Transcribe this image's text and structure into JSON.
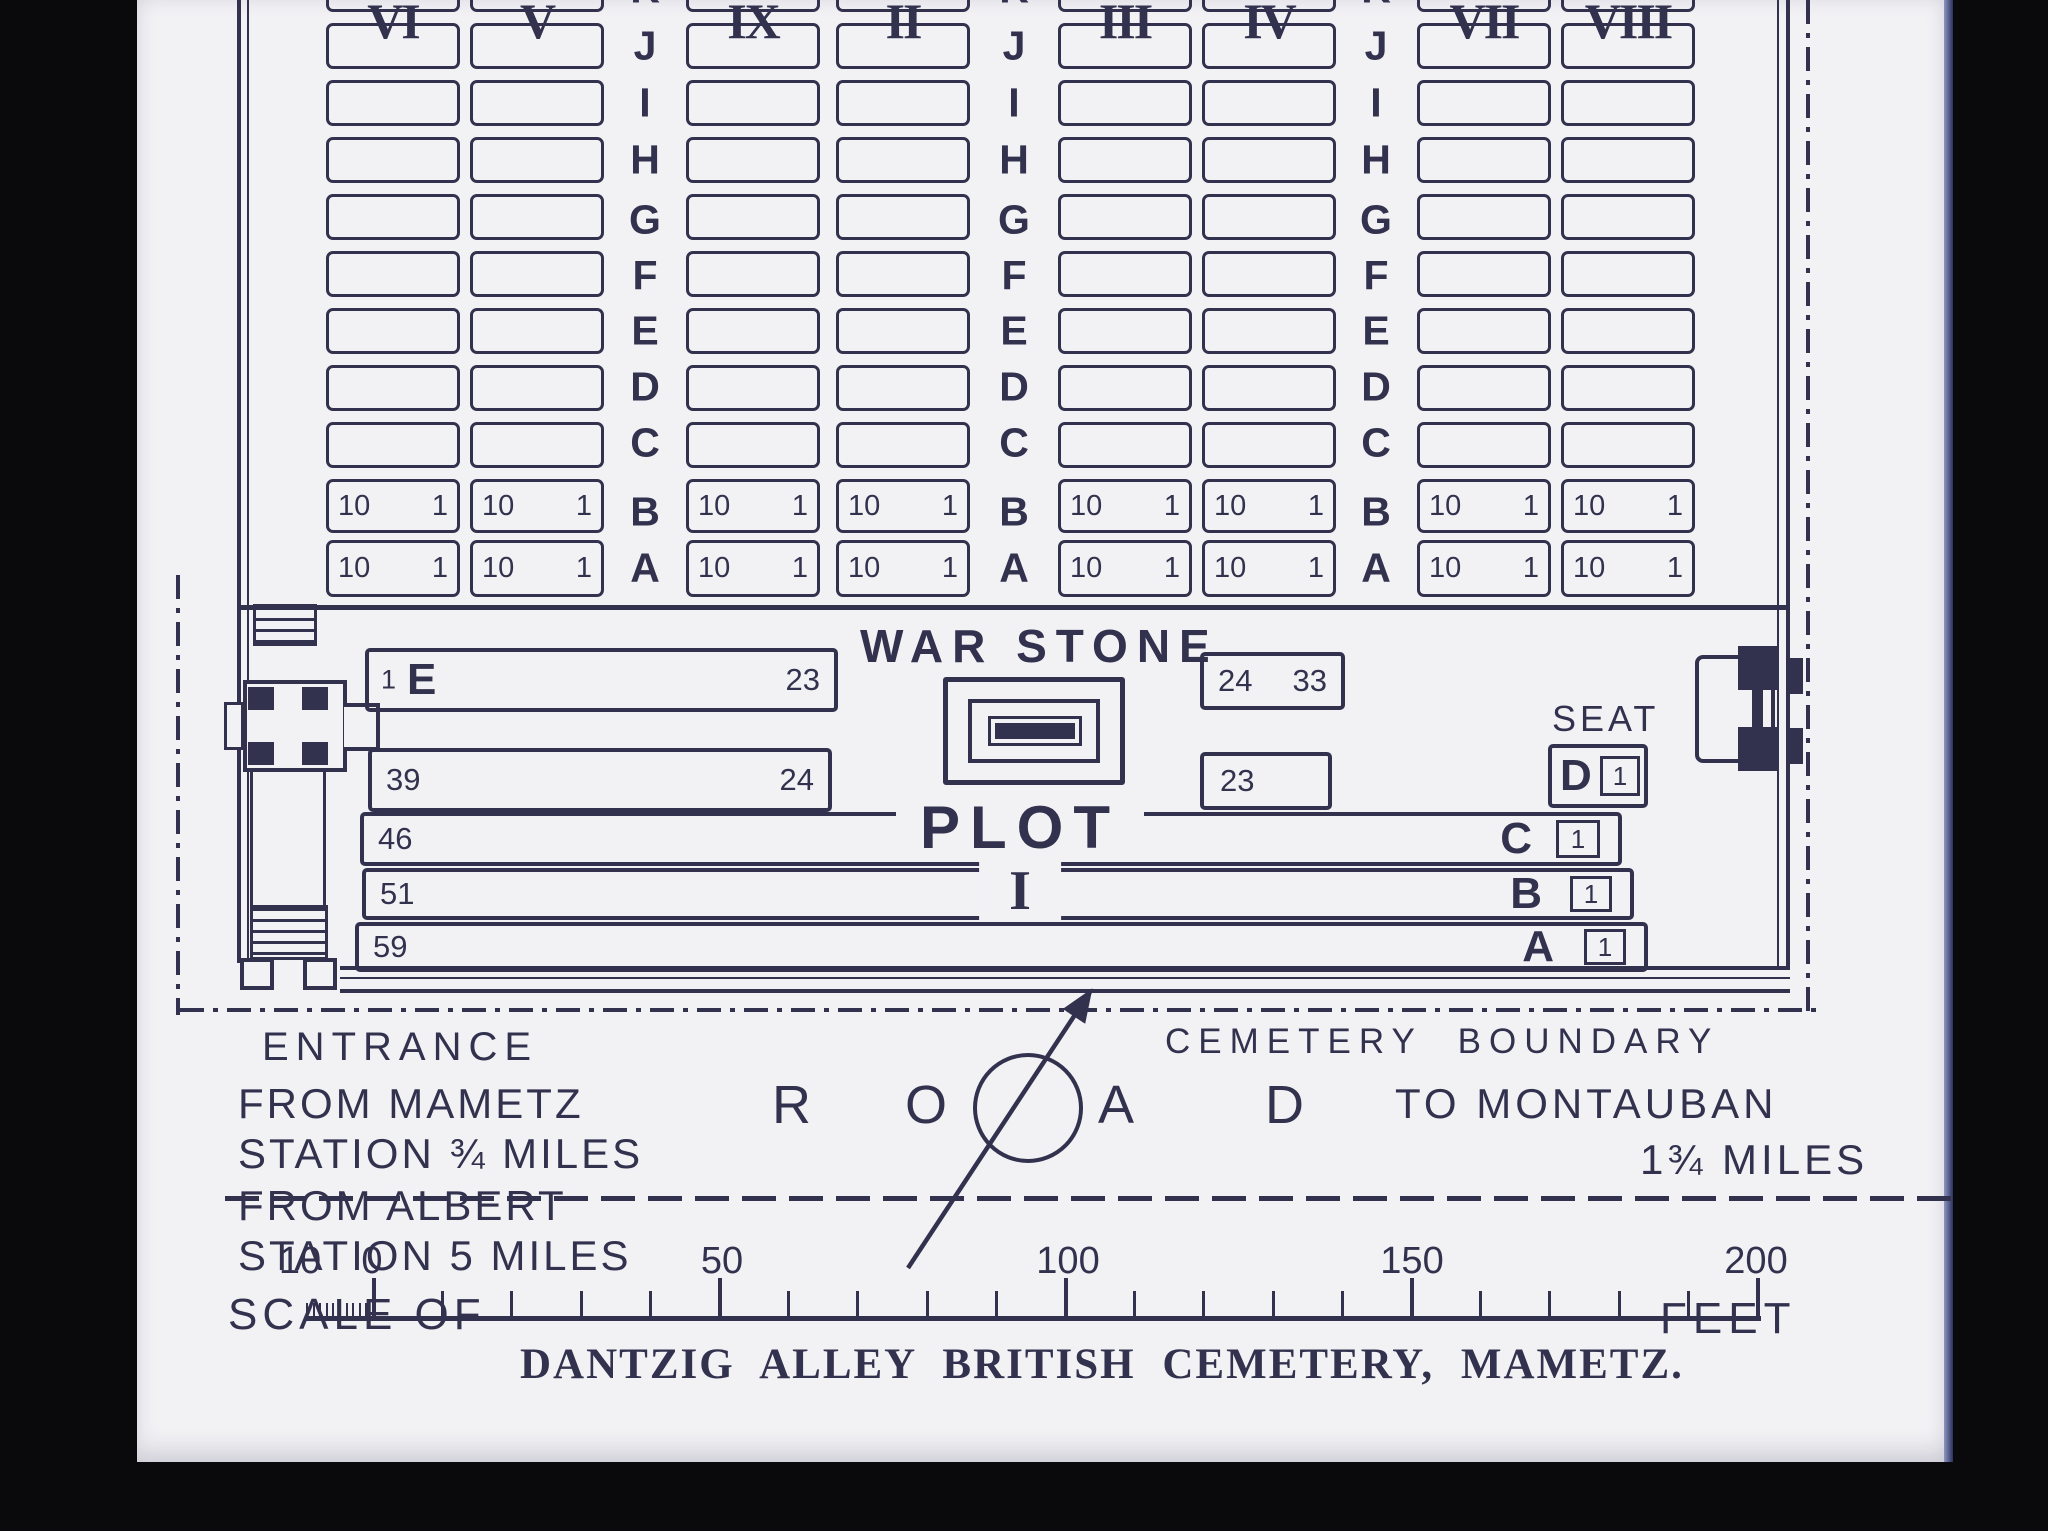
{
  "colors": {
    "ink": "#32324f",
    "paper": "#f2f1f4",
    "background": "#0a0a0c"
  },
  "plots": {
    "columns": [
      {
        "numeral": "VI"
      },
      {
        "numeral": "V"
      },
      {
        "numeral": "IX"
      },
      {
        "numeral": "II"
      },
      {
        "numeral": "III"
      },
      {
        "numeral": "IV"
      },
      {
        "numeral": "VII"
      },
      {
        "numeral": "VIII"
      }
    ],
    "row_letters": [
      "K",
      "J",
      "I",
      "H",
      "G",
      "F",
      "E",
      "D",
      "C",
      "B",
      "A"
    ],
    "numbered_rows": [
      "B",
      "A"
    ],
    "grave_left": "10",
    "grave_right": "1"
  },
  "war_stone": {
    "label": "WAR STONE"
  },
  "plot_i": {
    "plot_label": "PLOT",
    "plot_numeral": "I",
    "seat": "SEAT",
    "row_e": {
      "n1": "1",
      "letter": "E",
      "n2": "23"
    },
    "box_e2": {
      "n1": "24",
      "n2": "33"
    },
    "row_d": {
      "n1": "39",
      "n2": "24"
    },
    "box_d2": {
      "n1": "23"
    },
    "end_d": {
      "letter": "D",
      "n": "1"
    },
    "row_c": {
      "n1": "46",
      "letter": "C",
      "n": "1"
    },
    "row_b": {
      "n1": "51",
      "letter": "B",
      "n": "1"
    },
    "row_a": {
      "n1": "59",
      "letter": "A",
      "n": "1"
    }
  },
  "labels": {
    "entrance": "ENTRANCE",
    "cemetery_boundary": "CEMETERY  BOUNDARY",
    "from_mametz_1": "FROM MAMETZ",
    "from_mametz_2": "STATION ¾ MILES",
    "from_albert_1": "FROM ALBERT",
    "from_albert_2": "STATION 5 MILES",
    "road_letters": [
      "R",
      "O",
      "A",
      "D"
    ],
    "to_montauban_1": "TO MONTAUBAN",
    "to_montauban_2": "1¾ MILES"
  },
  "scale": {
    "tick_labels": [
      "10",
      "0",
      "50",
      "100",
      "150",
      "200"
    ],
    "scale_of": "SCALE OF",
    "feet": "FEET"
  },
  "title": "DANTZIG ALLEY BRITISH CEMETERY, MAMETZ."
}
